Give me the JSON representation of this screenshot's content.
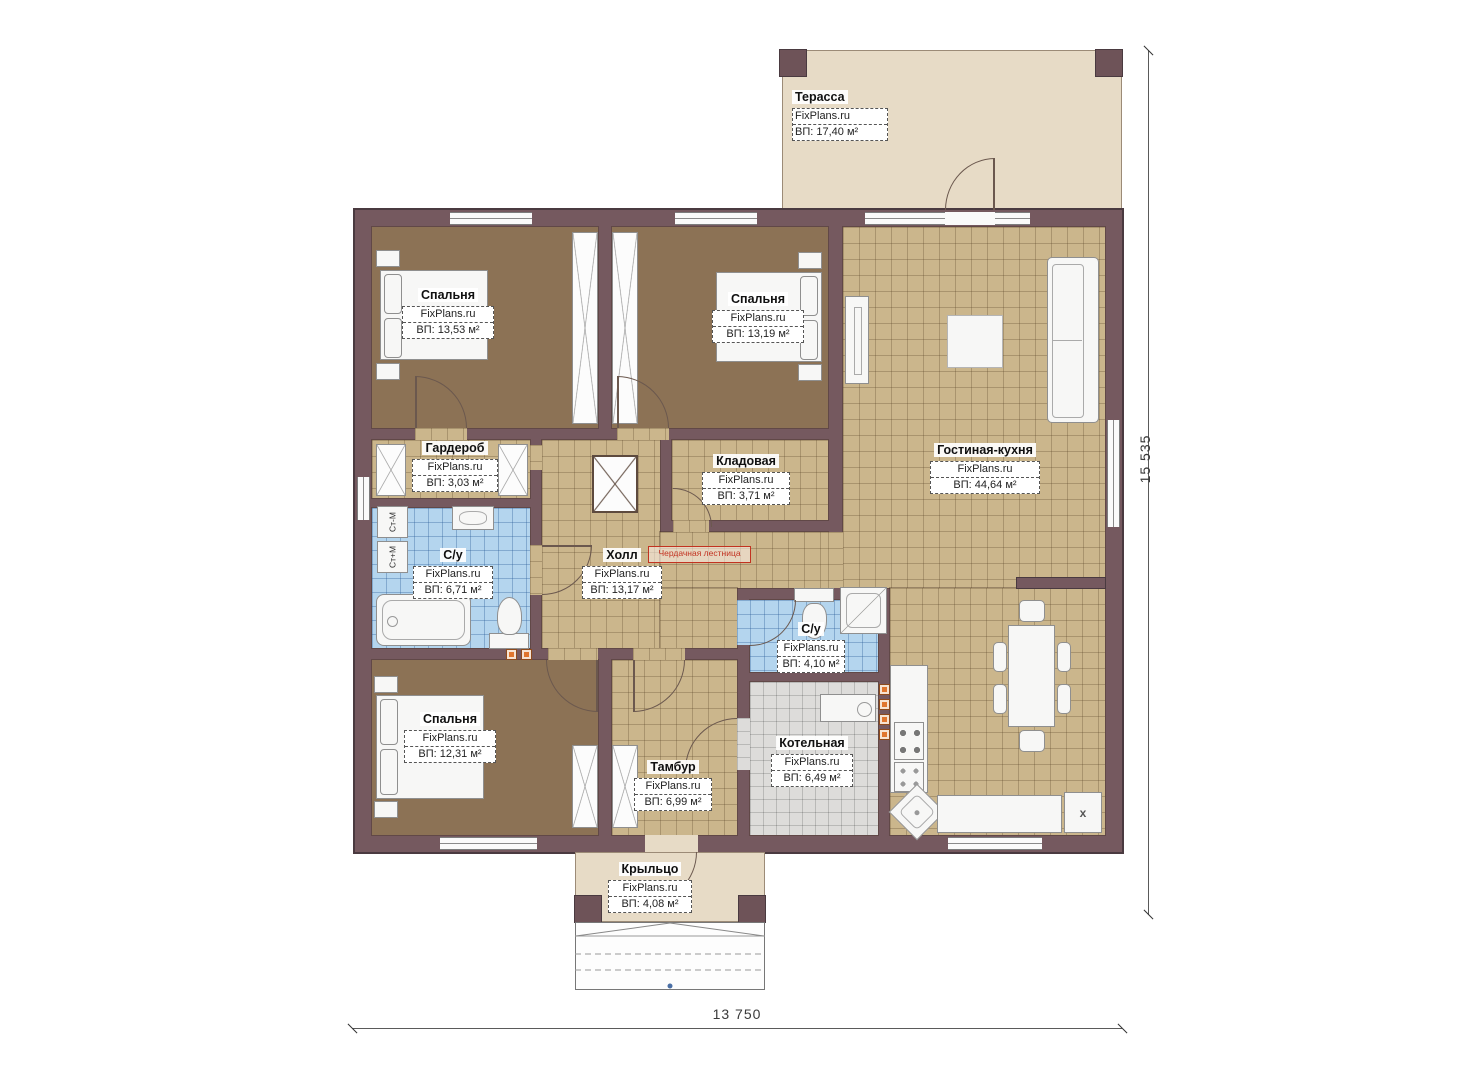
{
  "plan": {
    "brand": "FixPlans.ru",
    "rooms": [
      {
        "id": "terrace",
        "name": "Терасса",
        "area": "ВП: 17,40 м²"
      },
      {
        "id": "bedroom-1",
        "name": "Спальня",
        "area": "ВП: 13,53 м²"
      },
      {
        "id": "bedroom-2",
        "name": "Спальня",
        "area": "ВП: 13,19 м²"
      },
      {
        "id": "wardrobe",
        "name": "Гардероб",
        "area": "ВП: 3,03 м²"
      },
      {
        "id": "storage",
        "name": "Кладовая",
        "area": "ВП: 3,71 м²"
      },
      {
        "id": "bathroom-1",
        "name": "С/у",
        "area": "ВП: 6,71 м²"
      },
      {
        "id": "hall",
        "name": "Холл",
        "area": "ВП: 13,17 м²"
      },
      {
        "id": "living-kitchen",
        "name": "Гостиная-кухня",
        "area": "ВП: 44,64 м²"
      },
      {
        "id": "bathroom-2",
        "name": "С/у",
        "area": "ВП: 4,10 м²"
      },
      {
        "id": "bedroom-3",
        "name": "Спальня",
        "area": "ВП: 12,31 м²"
      },
      {
        "id": "vestibule",
        "name": "Тамбур",
        "area": "ВП: 6,99 м²"
      },
      {
        "id": "boiler-room",
        "name": "Котельная",
        "area": "ВП: 6,49 м²"
      },
      {
        "id": "porch",
        "name": "Крыльцо",
        "area": "ВП: 4,08 м²"
      }
    ],
    "annotations": {
      "attic_ladder": "Чердачная лестница",
      "washer_top": "Ст-М",
      "washer_bottom": "Ст+М",
      "fridge_mark": "x"
    },
    "dimensions": {
      "right": "15 535",
      "bottom": "13 750"
    },
    "colors": {
      "wall": "#75595f",
      "floor_tan": "#cbb68c",
      "floor_brown": "#8c7255",
      "floor_blue": "#b4d5ee",
      "floor_gray": "#dddcda",
      "terrace": "#e7dbc6",
      "accent_orange": "#e0762e",
      "annotation_red": "#c23321"
    }
  }
}
